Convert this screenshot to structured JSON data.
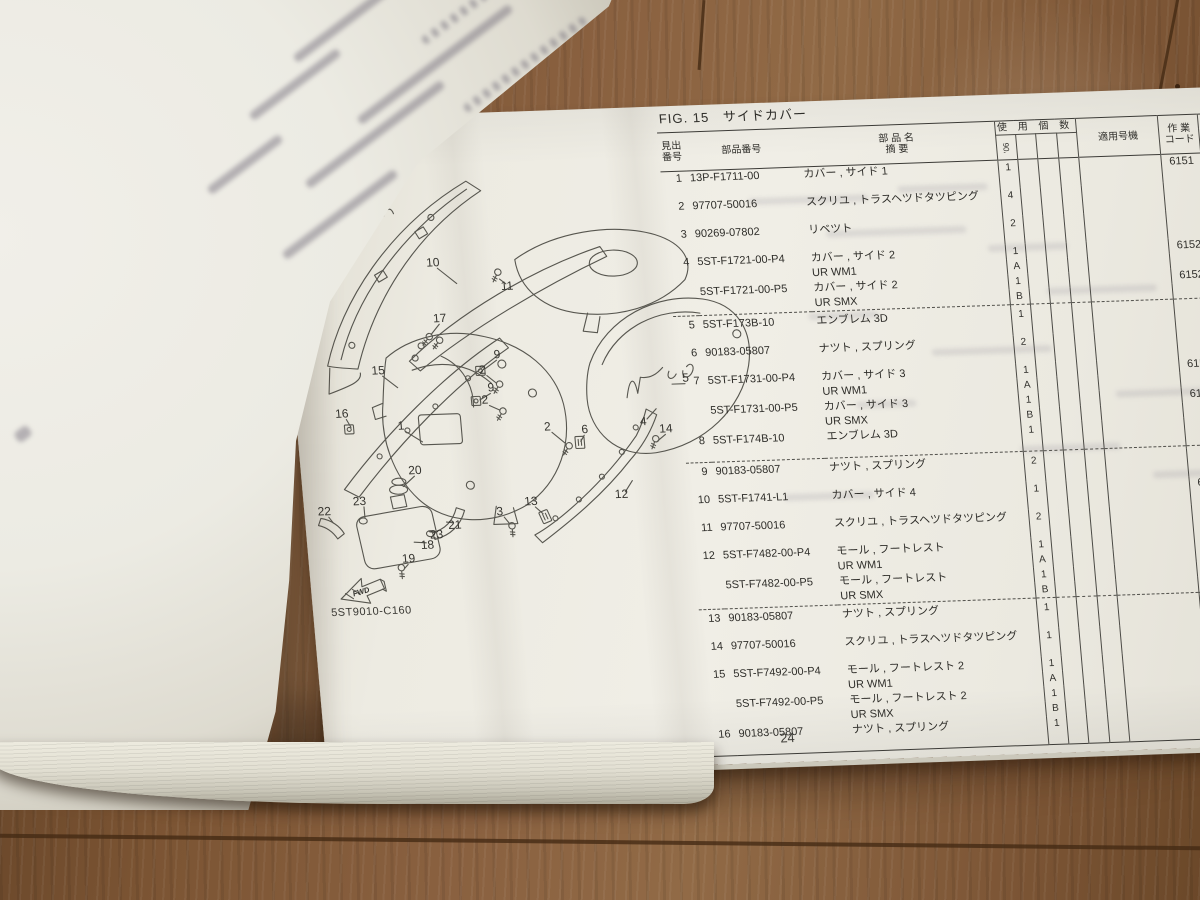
{
  "window": {
    "page_number": "24"
  },
  "figure": {
    "label": "FIG. 15",
    "title": "サイドカバー",
    "drawing_code": "5ST9010-C160",
    "fwd": "FWD"
  },
  "table": {
    "headers": {
      "ref1": "見出",
      "ref2": "番号",
      "part": "部品番号",
      "name1": "部  品  名",
      "name2": "摘        要",
      "qty_group": "使 用 個 数",
      "qty_model": "'06",
      "applicable": "適用号機",
      "code1": "作 業",
      "code2": "コード",
      "time1": "整 備",
      "time2": "時 間"
    },
    "lines": [
      {
        "no": "1",
        "part": "13P-F1711-00",
        "desc": "カバー , サイド 1",
        "qty": "1",
        "code": "6151",
        "time": "0.3",
        "gap": true
      },
      {
        "no": "2",
        "part": "97707-50016",
        "desc": "スクリユ , トラスヘツドタツピング",
        "qty": "4",
        "gap": true
      },
      {
        "no": "3",
        "part": "90269-07802",
        "desc": "リベツト",
        "qty": "2",
        "gap": true
      },
      {
        "no": "4",
        "part": "5ST-F1721-00-P4",
        "desc": "カバー , サイド 2",
        "qty": "1",
        "code": "6152",
        "time": "0.3"
      },
      {
        "desc": "UR WM1",
        "qty": "A"
      },
      {
        "part": "5ST-F1721-00-P5",
        "desc": "カバー , サイド 2",
        "qty": "1",
        "code": "6152",
        "time": "0.3"
      },
      {
        "desc": "UR SMX",
        "qty": "B",
        "dash": true
      },
      {
        "no": "5",
        "part": "5ST-F173B-10",
        "desc": "エンブレム 3D",
        "qty": "1",
        "gap": true
      },
      {
        "no": "6",
        "part": "90183-05807",
        "desc": "ナツト , スプリング",
        "qty": "2",
        "gap": true
      },
      {
        "no": "7",
        "part": "5ST-F1731-00-P4",
        "desc": "カバー , サイド 3",
        "qty": "1",
        "code": "6153",
        "time": "0.3"
      },
      {
        "desc": "UR WM1",
        "qty": "A"
      },
      {
        "part": "5ST-F1731-00-P5",
        "desc": "カバー , サイド 3",
        "qty": "1",
        "code": "6153",
        "time": "0.3"
      },
      {
        "desc": "UR SMX",
        "qty": "B"
      },
      {
        "no": "8",
        "part": "5ST-F174B-10",
        "desc": "エンブレム 3D",
        "qty": "1",
        "gap": true,
        "dash": true
      },
      {
        "no": "9",
        "part": "90183-05807",
        "desc": "ナツト , スプリング",
        "qty": "2",
        "gap": true
      },
      {
        "no": "10",
        "part": "5ST-F1741-L1",
        "desc": "カバー , サイド 4",
        "qty": "1",
        "code": "6154",
        "time": "0.4",
        "gap": true
      },
      {
        "no": "11",
        "part": "97707-50016",
        "desc": "スクリユ , トラスヘツドタツピング",
        "qty": "2",
        "gap": true
      },
      {
        "no": "12",
        "part": "5ST-F7482-00-P4",
        "desc": "モール , フートレスト",
        "qty": "1",
        "code": "6157",
        "time": "0.1"
      },
      {
        "desc": "UR WM1",
        "qty": "A"
      },
      {
        "part": "5ST-F7482-00-P5",
        "desc": "モール , フートレスト",
        "qty": "1",
        "code": "6157",
        "time": "0.1"
      },
      {
        "desc": "UR SMX",
        "qty": "B",
        "dash": true
      },
      {
        "no": "13",
        "part": "90183-05807",
        "desc": "ナツト , スプリング",
        "qty": "1",
        "gap": true
      },
      {
        "no": "14",
        "part": "97707-50016",
        "desc": "スクリユ , トラスヘツドタツピング",
        "qty": "1",
        "gap": true
      },
      {
        "no": "15",
        "part": "5ST-F7492-00-P4",
        "desc": "モール , フートレスト 2",
        "qty": "1",
        "code": "6157",
        "time": "0.1"
      },
      {
        "desc": "UR WM1",
        "qty": "A"
      },
      {
        "part": "5ST-F7492-00-P5",
        "desc": "モール , フートレスト 2",
        "qty": "1",
        "code": "6157",
        "time": "0.1"
      },
      {
        "desc": "UR SMX",
        "qty": "B"
      },
      {
        "no": "16",
        "part": "90183-05807",
        "desc": "ナツト , スプリング",
        "qty": "1",
        "gap": true
      }
    ]
  },
  "diagram": {
    "callouts": [
      {
        "n": "7",
        "x": 50,
        "y": 124,
        "tx": 64,
        "ty": 140
      },
      {
        "n": "8",
        "x": 88,
        "y": 92,
        "tx": 82,
        "ty": 100
      },
      {
        "n": "10",
        "x": 150,
        "y": 152,
        "tx": 172,
        "ty": 170
      },
      {
        "n": "11",
        "x": 222,
        "y": 178,
        "tx": 215,
        "ty": 167
      },
      {
        "n": "17",
        "x": 152,
        "y": 208,
        "tx": 142,
        "ty": 220
      },
      {
        "n": "15",
        "x": 86,
        "y": 258,
        "tx": 104,
        "ty": 272
      },
      {
        "n": "16",
        "x": 46,
        "y": 300,
        "tx": 54,
        "ty": 310
      },
      {
        "n": "9",
        "x": 206,
        "y": 246,
        "tx": 193,
        "ty": 256
      },
      {
        "n": "2",
        "x": 190,
        "y": 261,
        "tx": 203,
        "ty": 271
      },
      {
        "n": "9",
        "x": 197,
        "y": 279,
        "tx": 185,
        "ty": 287
      },
      {
        "n": "2",
        "x": 190,
        "y": 291,
        "tx": 204,
        "ty": 298
      },
      {
        "n": "1",
        "x": 104,
        "y": 314,
        "tx": 124,
        "ty": 327
      },
      {
        "n": "2",
        "x": 250,
        "y": 320,
        "tx": 266,
        "ty": 333
      },
      {
        "n": "6",
        "x": 287,
        "y": 324,
        "tx": 282,
        "ty": 332
      },
      {
        "n": "5",
        "x": 392,
        "y": 276,
        "tx": 378,
        "ty": 278
      },
      {
        "n": "4",
        "x": 346,
        "y": 318,
        "tx": 360,
        "ty": 302
      },
      {
        "n": "14",
        "x": 368,
        "y": 326,
        "tx": 359,
        "ty": 334
      },
      {
        "n": "12",
        "x": 318,
        "y": 390,
        "tx": 330,
        "ty": 373
      },
      {
        "n": "13",
        "x": 227,
        "y": 394,
        "tx": 238,
        "ty": 403
      },
      {
        "n": "3",
        "x": 195,
        "y": 403,
        "tx": 204,
        "ty": 412
      },
      {
        "n": "20",
        "x": 114,
        "y": 359,
        "tx": 101,
        "ty": 371
      },
      {
        "n": "23",
        "x": 56,
        "y": 388,
        "tx": 60,
        "ty": 401
      },
      {
        "n": "22",
        "x": 20,
        "y": 397,
        "tx": 28,
        "ty": 405
      },
      {
        "n": "21",
        "x": 149,
        "y": 415,
        "tx": 141,
        "ty": 408
      },
      {
        "n": "23",
        "x": 130,
        "y": 424,
        "tx": 123,
        "ty": 417
      },
      {
        "n": "18",
        "x": 120,
        "y": 434,
        "tx": 107,
        "ty": 427
      },
      {
        "n": "19",
        "x": 100,
        "y": 447,
        "tx": 95,
        "ty": 453
      }
    ]
  }
}
